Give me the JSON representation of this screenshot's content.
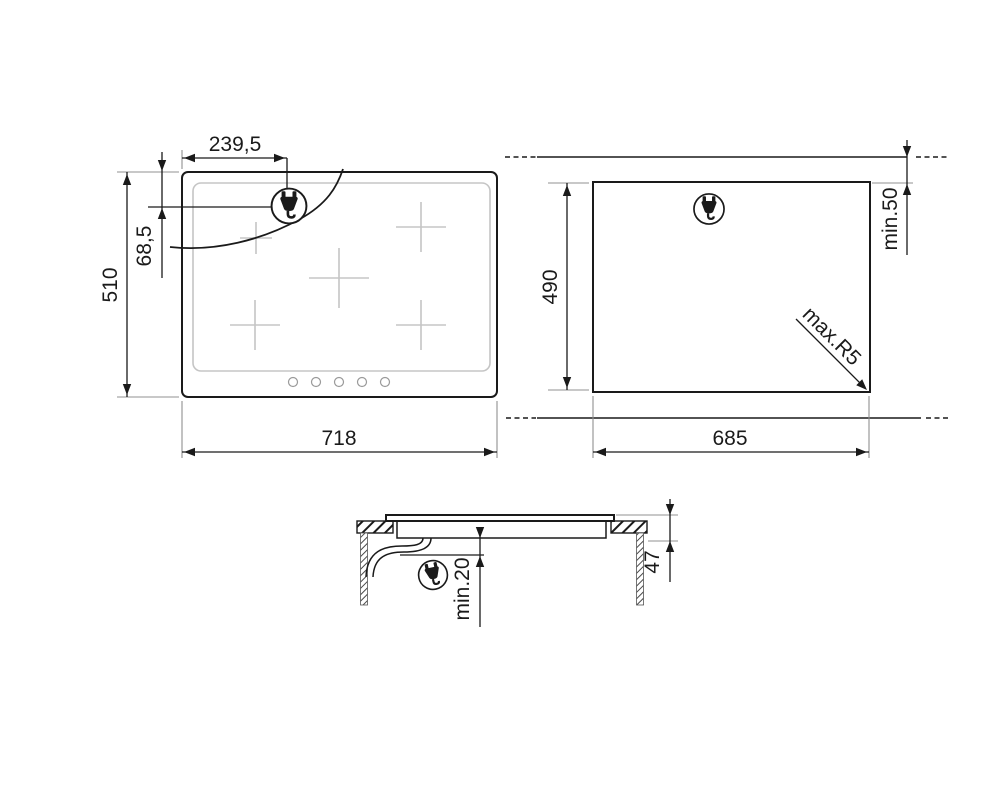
{
  "colors": {
    "line": "#1a1a1a",
    "extension_line": "#909090",
    "light_gray": "#c5c5c5"
  },
  "icons": {
    "power_plug": "power-plug-icon"
  },
  "views": {
    "top": {
      "width": "718",
      "height": "510",
      "plug_offset_x": "239,5",
      "plug_offset_y": "68,5"
    },
    "cutout": {
      "width": "685",
      "height": "490",
      "rear_clearance": "min.50",
      "corner_radius": "max.R5"
    },
    "section": {
      "depth": "47",
      "clearance_below": "min.20"
    }
  }
}
